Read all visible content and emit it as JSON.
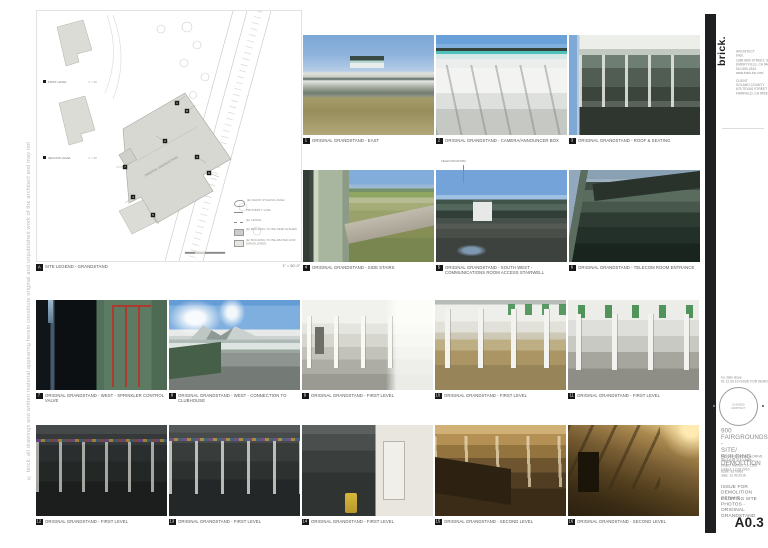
{
  "sheet": {
    "logo": "brick.",
    "side_note": "© brick.  all drawings and written material appearing herein constitute original and unpublished work of the architect and may not be duplicated, used or disclosed without the written consent of the architect.",
    "sheet_number": "A0.3"
  },
  "titleblock": {
    "architect": [
      "ARCHITECT",
      "brick.",
      "1286 66th STREET, STUDIO 1",
      "EMERYVILLE, CA 94608",
      "510.550.2610",
      "www.brick-inc.com"
    ],
    "client": [
      "CLIENT",
      "SOLANO COUNTY",
      "675 TEXAS STREET",
      "FAIRFIELD, CA 94533"
    ],
    "revisions": [
      "no.  date        issue",
      "01    12.09.16   ISSUE FOR DEMOLITION PERMIT"
    ],
    "stamp": [
      "LICENSED",
      "ARCHITECT"
    ],
    "project_title": [
      "900",
      "FAIRGROUNDS -",
      "SITE/ BUILDING",
      "DEMOLITION"
    ],
    "project_address": [
      "900 FAIRGROUNDS DRIVE",
      "VALLEJO, CA 94589"
    ],
    "project_meta": [
      "project number: 16-1128",
      "printed: 12.09.2016"
    ],
    "scale_note": "scale: as noted",
    "date_note": "date: 12.09.2016",
    "issue": [
      "ISSUE FOR",
      "DEMOLITION PERMIT"
    ],
    "sheet_title": [
      "EXISTING SITE",
      "PHOTOS -",
      "ORIGINAL",
      "GRANDSTAND"
    ]
  },
  "plan": {
    "marker": "A",
    "label": "SITE LEGEND - GRANDSTAND",
    "scale": "1\" = 50'-0\"",
    "inset1_label": "FIRST LEVEL",
    "inset1_scale": "1\" = 40'",
    "inset2_label": "SECOND LEVEL",
    "inset2_scale": "1\" = 40'",
    "building_label": "ORIGINAL GRANDSTAND",
    "markers": [
      "1",
      "2",
      "3",
      "4",
      "5",
      "6",
      "7",
      "8"
    ],
    "telecom_note": "TELECOM ROOM",
    "legend": [
      "(E) DEMO STAGING AREA",
      "PROPERTY LINE",
      "(E) FENCE",
      "(E) BUILDING TO BE DEMOLISHED",
      "(E) BUILDING TO BE ABATED AND DEMOLISHED"
    ]
  },
  "photos": [
    {
      "num": "1",
      "caption": "ORIGINAL GRANDSTAND - EAST"
    },
    {
      "num": "2",
      "caption": "ORIGINAL GRANDSTAND - CAMERA/ANNOUNCER BOX"
    },
    {
      "num": "3",
      "caption": "ORIGINAL GRANDSTAND - ROOF & SEATING"
    },
    {
      "num": "4",
      "caption": "ORIGINAL GRANDSTAND - SIDE STAIRS"
    },
    {
      "num": "5",
      "caption": "ORIGINAL GRANDSTAND - SOUTH WEST - COMMUNICATIONS ROOM ACCESS STAIRWELL"
    },
    {
      "num": "6",
      "caption": "ORIGINAL GRANDSTAND - TELECOM ROOM ENTRANCE"
    },
    {
      "num": "7",
      "caption": "ORIGINAL GRANDSTAND - WEST - SPRINKLER CONTROL VALVE"
    },
    {
      "num": "8",
      "caption": "ORIGINAL GRANDSTAND - WEST - CONNECTION TO CLUBHOUSE"
    },
    {
      "num": "9",
      "caption": "ORIGINAL GRANDSTAND - FIRST LEVEL"
    },
    {
      "num": "10",
      "caption": "ORIGINAL GRANDSTAND - FIRST LEVEL"
    },
    {
      "num": "11",
      "caption": "ORIGINAL GRANDSTAND - FIRST LEVEL"
    },
    {
      "num": "12",
      "caption": "ORIGINAL GRANDSTAND - FIRST LEVEL"
    },
    {
      "num": "13",
      "caption": "ORIGINAL GRANDSTAND - FIRST LEVEL"
    },
    {
      "num": "14",
      "caption": "ORIGINAL GRANDSTAND - FIRST LEVEL"
    },
    {
      "num": "15",
      "caption": "ORIGINAL GRANDSTAND - SECOND LEVEL"
    },
    {
      "num": "16",
      "caption": "ORIGINAL GRANDSTAND - SECOND LEVEL"
    }
  ]
}
